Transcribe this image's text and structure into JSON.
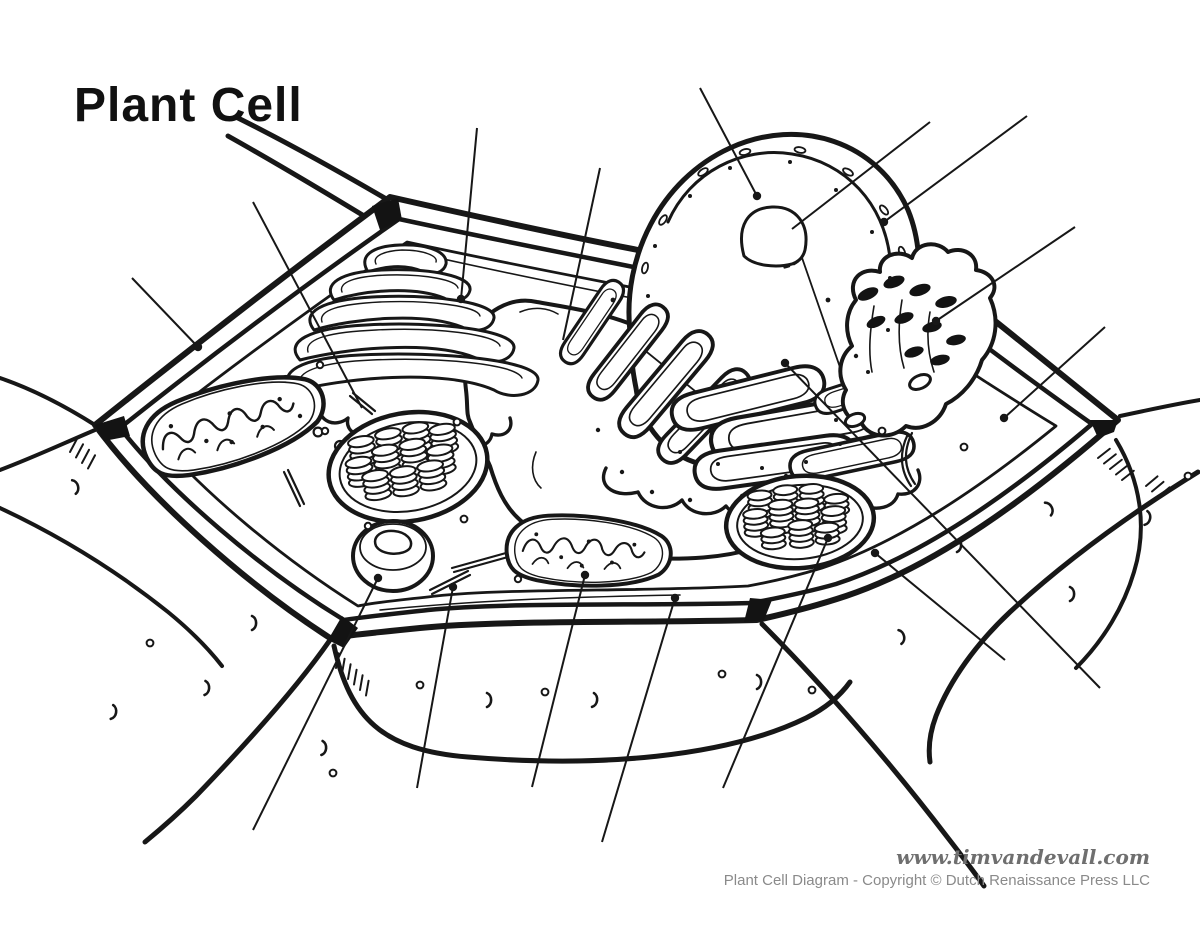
{
  "page": {
    "title": "Plant Cell"
  },
  "footer": {
    "website": "www.timvandevall.com",
    "copyright": "Plant Cell Diagram - Copyright © Dutch Renaissance Press LLC"
  },
  "colors": {
    "ink": "#171717",
    "paper": "#ffffff",
    "muted_text": "#8a8a8a"
  },
  "diagram": {
    "leader_lines": [
      {
        "target": "cell-wall",
        "from": [
          132,
          278
        ],
        "to": [
          198,
          347
        ],
        "dot": true
      },
      {
        "target": "cytoskeleton",
        "from": [
          253,
          202
        ],
        "to": [
          362,
          408
        ],
        "dot": false
      },
      {
        "target": "golgi-apparatus",
        "from": [
          477,
          128
        ],
        "to": [
          461,
          299
        ],
        "dot": true
      },
      {
        "target": "central-vacuole",
        "from": [
          600,
          168
        ],
        "to": [
          563,
          340
        ],
        "dot": false
      },
      {
        "target": "nucleus",
        "from": [
          700,
          88
        ],
        "to": [
          757,
          196
        ],
        "dot": true
      },
      {
        "target": "nucleolus",
        "from": [
          930,
          122
        ],
        "to": [
          792,
          229
        ],
        "dot": false
      },
      {
        "target": "nuclear-envelope",
        "from": [
          1027,
          116
        ],
        "to": [
          884,
          222
        ],
        "dot": true
      },
      {
        "target": "smooth-endoplasmic-reticulum",
        "from": [
          1075,
          227
        ],
        "to": [
          936,
          321
        ],
        "dot": true
      },
      {
        "target": "cytoplasm",
        "from": [
          1105,
          327
        ],
        "to": [
          1004,
          418
        ],
        "dot": true
      },
      {
        "target": "rough-endoplasmic-reticulum",
        "from": [
          1100,
          688
        ],
        "to": [
          785,
          363
        ],
        "dot": true
      },
      {
        "target": "chloroplast",
        "from": [
          1005,
          660
        ],
        "to": [
          875,
          553
        ],
        "dot": true
      },
      {
        "target": "granum",
        "from": [
          723,
          788
        ],
        "to": [
          828,
          538
        ],
        "dot": true
      },
      {
        "target": "cell-membrane",
        "from": [
          602,
          842
        ],
        "to": [
          675,
          598
        ],
        "dot": true
      },
      {
        "target": "mitochondrion",
        "from": [
          532,
          787
        ],
        "to": [
          585,
          575
        ],
        "dot": true
      },
      {
        "target": "cytoskeleton-b",
        "from": [
          417,
          788
        ],
        "to": [
          453,
          587
        ],
        "dot": true
      },
      {
        "target": "peroxisome",
        "from": [
          253,
          830
        ],
        "to": [
          378,
          578
        ],
        "dot": true
      }
    ],
    "ribosome_dots": [
      [
        320,
        365,
        3.2
      ],
      [
        325,
        431,
        3.2
      ],
      [
        457,
        422,
        3.4
      ],
      [
        464,
        519,
        3.4
      ],
      [
        368,
        526,
        3.2
      ],
      [
        518,
        579,
        3.2
      ],
      [
        882,
        431,
        3.4
      ],
      [
        964,
        447,
        3.4
      ],
      [
        622,
        472,
        2.2
      ],
      [
        652,
        492,
        2.2
      ],
      [
        690,
        500,
        2.2
      ],
      [
        742,
        496,
        2.2
      ],
      [
        786,
        476,
        2.2
      ],
      [
        828,
        300,
        2.4
      ],
      [
        613,
        300,
        2.4
      ],
      [
        598,
        430,
        2.2
      ],
      [
        300,
        416,
        2.2
      ],
      [
        856,
        356,
        2.2
      ]
    ],
    "nucleus_pores": [
      [
        703,
        172,
        -35
      ],
      [
        745,
        152,
        -15
      ],
      [
        800,
        150,
        10
      ],
      [
        848,
        172,
        30
      ],
      [
        884,
        210,
        50
      ],
      [
        902,
        252,
        70
      ],
      [
        906,
        296,
        85
      ],
      [
        898,
        340,
        100
      ],
      [
        880,
        380,
        115
      ],
      [
        856,
        412,
        130
      ],
      [
        663,
        220,
        -55
      ],
      [
        645,
        268,
        -75
      ],
      [
        643,
        316,
        -88
      ]
    ],
    "nucleus_dots": [
      [
        690,
        196
      ],
      [
        730,
        168
      ],
      [
        790,
        162
      ],
      [
        836,
        190
      ],
      [
        872,
        232
      ],
      [
        890,
        278
      ],
      [
        888,
        330
      ],
      [
        868,
        372
      ],
      [
        836,
        420
      ],
      [
        655,
        246
      ],
      [
        648,
        296
      ],
      [
        680,
        452
      ],
      [
        718,
        464
      ],
      [
        762,
        468
      ],
      [
        806,
        462
      ],
      [
        840,
        444
      ]
    ],
    "chloroplasts": [
      {
        "cx": 408,
        "cy": 467,
        "rot": -10,
        "rx": 80,
        "ry": 54,
        "irx": 69,
        "iry": 44,
        "coin_rx": 13,
        "coin_ry": 5.2,
        "gap": 6.4,
        "stacks": [
          [
            -42,
            -14,
            4
          ],
          [
            -14,
            -17,
            4
          ],
          [
            14,
            -18,
            4
          ],
          [
            40,
            -12,
            4
          ],
          [
            -48,
            6,
            4
          ],
          [
            -20,
            5,
            5
          ],
          [
            8,
            4,
            5
          ],
          [
            34,
            8,
            4
          ],
          [
            -34,
            22,
            4
          ],
          [
            -6,
            23,
            4
          ],
          [
            22,
            22,
            4
          ]
        ]
      },
      {
        "cx": 800,
        "cy": 522,
        "rot": -5,
        "rx": 74,
        "ry": 46,
        "irx": 63,
        "iry": 37,
        "coin_rx": 12,
        "coin_ry": 4.8,
        "gap": 6.0,
        "stacks": [
          [
            -38,
            -12,
            4
          ],
          [
            -12,
            -15,
            4
          ],
          [
            14,
            -14,
            4
          ],
          [
            38,
            -8,
            3
          ],
          [
            -44,
            6,
            4
          ],
          [
            -18,
            5,
            5
          ],
          [
            8,
            6,
            5
          ],
          [
            34,
            10,
            4
          ],
          [
            -28,
            20,
            3
          ],
          [
            0,
            21,
            4
          ],
          [
            26,
            20,
            3
          ]
        ]
      }
    ],
    "decor": {
      "curls": [
        [
          74,
          487,
          -15
        ],
        [
          112,
          712,
          10
        ],
        [
          252,
          623,
          0
        ],
        [
          322,
          748,
          5
        ],
        [
          487,
          700,
          0
        ],
        [
          593,
          700,
          8
        ],
        [
          757,
          682,
          0
        ],
        [
          900,
          637,
          -12
        ],
        [
          957,
          545,
          0
        ],
        [
          1048,
          509,
          -25
        ],
        [
          1146,
          518,
          12
        ],
        [
          1070,
          594,
          0
        ],
        [
          205,
          688,
          4
        ]
      ],
      "dots": [
        [
          420,
          685
        ],
        [
          333,
          773
        ],
        [
          545,
          692
        ],
        [
          722,
          674
        ],
        [
          150,
          643
        ],
        [
          1188,
          476
        ],
        [
          812,
          690
        ]
      ],
      "hatch_groups": [
        [
          70,
          452,
          -62,
          4
        ],
        [
          336,
          668,
          -80,
          6
        ],
        [
          1098,
          458,
          -38,
          5
        ],
        [
          394,
          594,
          -48,
          3
        ],
        [
          222,
          514,
          -58,
          3
        ],
        [
          1146,
          486,
          -40,
          3
        ]
      ]
    }
  }
}
